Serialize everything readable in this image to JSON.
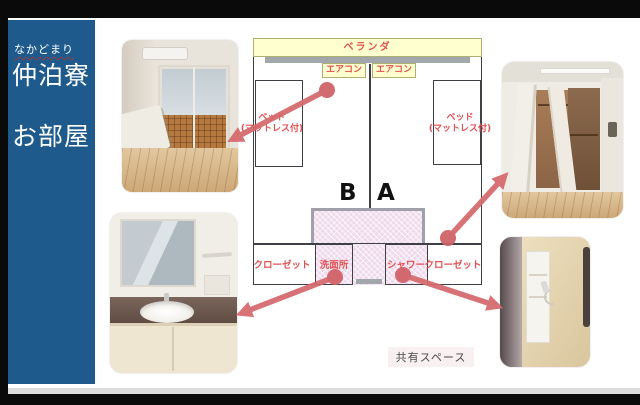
{
  "sidebar": {
    "furigana": "なかどまり",
    "dorm_name": "仲泊寮",
    "page_title": "お部屋"
  },
  "floorplan": {
    "veranda": "ベランダ",
    "aircon_b": "エアコン",
    "aircon_a": "エアコン",
    "bed_b_line1": "ベッド",
    "bed_b_line2": "(マットレス付)",
    "bed_a_line1": "ベッド",
    "bed_a_line2": "(マットレス付)",
    "room_b": "B",
    "room_a": "A",
    "closet_b": "クローゼット",
    "washroom": "洗面所",
    "shower": "シャワー",
    "closet_a": "クローゼット",
    "shared_space": "共有スペース"
  },
  "photos": {
    "top_left": "bedroom-photo",
    "top_right": "closet-photo",
    "bottom_left": "washbasin-photo",
    "bottom_right": "shower-photo"
  },
  "colors": {
    "sidebar_bg": "#1e5a8c",
    "label_red": "#e05252",
    "arrow_red": "#d5696c",
    "plan_yellow": "#ffffcf",
    "shared_pink": "#efd9ec"
  }
}
